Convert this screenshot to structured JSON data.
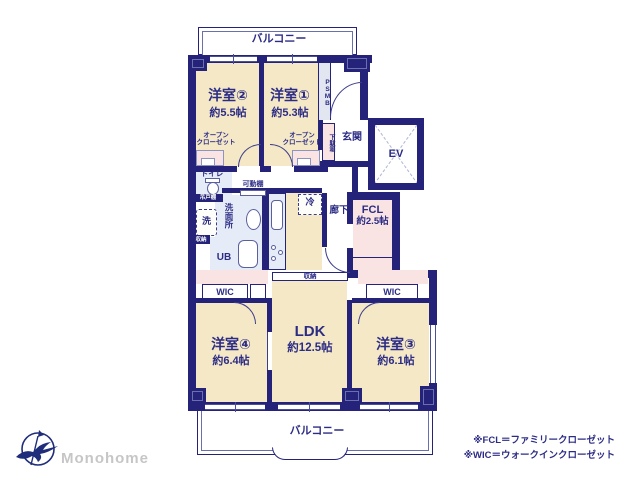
{
  "plan": {
    "balcony_top": "バルコニー",
    "balcony_bottom": "バルコニー",
    "rooms": {
      "y2": {
        "name": "洋室②",
        "size": "約5.5帖"
      },
      "y1": {
        "name": "洋室①",
        "size": "約5.3帖"
      },
      "y4": {
        "name": "洋室④",
        "size": "約6.4帖"
      },
      "y3": {
        "name": "洋室③",
        "size": "約6.1帖"
      },
      "ldk": {
        "name": "LDK",
        "size": "約12.5帖"
      },
      "fcl": {
        "name": "FCL",
        "size": "約2.5帖"
      }
    },
    "labels": {
      "genkan": "玄関",
      "ev": "EV",
      "psmb": "PSMB",
      "getabako": "下駄箱",
      "toilet": "トイレ",
      "tsuritodana": "吊戸棚",
      "kadoudana": "可動棚",
      "senmenjo": "洗面所",
      "sen": "洗",
      "shuno_left": "収納",
      "shuno_center": "収納",
      "ub": "UB",
      "rei": "冷",
      "rouka": "廊下",
      "wic_left": "WIC",
      "wic_right": "WIC",
      "open_closet_line1": "オープン",
      "open_closet_line2": "クローゼット"
    }
  },
  "legend": {
    "fcl": "※FCL＝ファミリークローゼット",
    "wic": "※WIC＝ウォークインクローゼット"
  },
  "logo": {
    "text": "Monohome"
  },
  "colors": {
    "wall": "#242379",
    "text": "#2c2c85",
    "room_floor": "#f4e8c7",
    "closet_pink": "#f9e4e3",
    "wet_blue": "#e6ecf7",
    "logo_text_gray": "#c6c6c6",
    "background": "#ffffff"
  }
}
